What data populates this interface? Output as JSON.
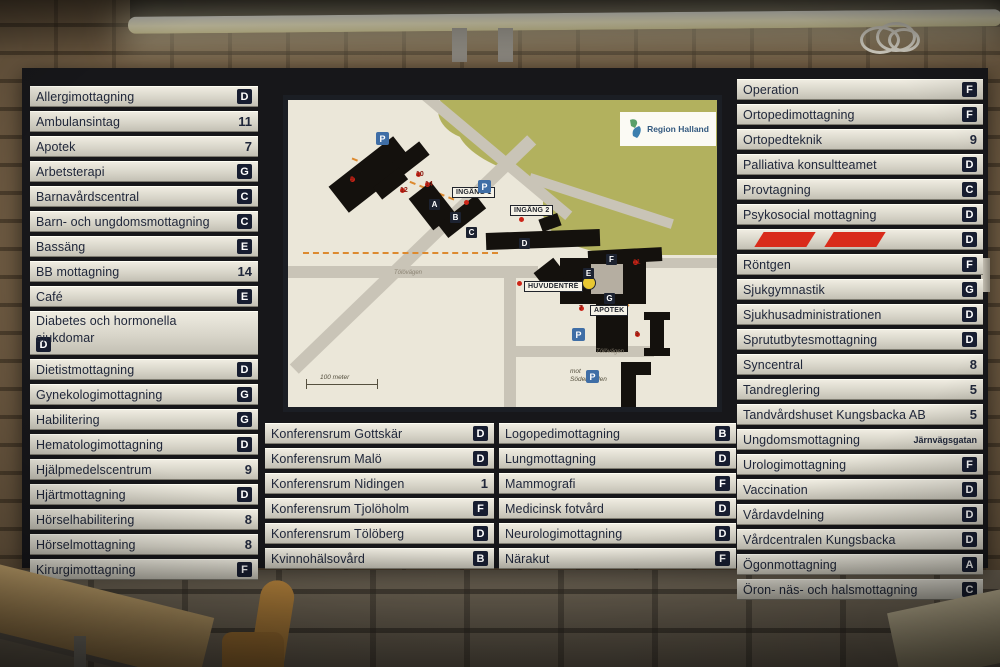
{
  "colors": {
    "badge_bg": "#171d30",
    "row_bg": "#d6d3c7",
    "hazard_red": "#d92b1b",
    "map_green": "#b2b15e",
    "parking_blue": "#3f6ea6",
    "path_orange": "#dd8a2f",
    "marker_red": "#cc2518"
  },
  "sign": {
    "left_column": [
      {
        "label": "Allergimottagning",
        "code": "D",
        "code_type": "badge"
      },
      {
        "label": "Ambulansintag",
        "code": "11",
        "code_type": "num"
      },
      {
        "label": "Apotek",
        "code": "7",
        "code_type": "num"
      },
      {
        "label": "Arbetsterapi",
        "code": "G",
        "code_type": "badge"
      },
      {
        "label": "Barnavårdscentral",
        "code": "C",
        "code_type": "badge"
      },
      {
        "label": "Barn- och ungdomsmottagning",
        "code": "C",
        "code_type": "badge"
      },
      {
        "label": "Bassäng",
        "code": "E",
        "code_type": "badge"
      },
      {
        "label": "BB mottagning",
        "code": "14",
        "code_type": "num"
      },
      {
        "label": "Café",
        "code": "E",
        "code_type": "badge"
      },
      {
        "label": "Diabetes och hormonella sjukdomar",
        "code": "D",
        "code_type": "badge",
        "wrap": true
      },
      {
        "label": "Dietistmottagning",
        "code": "D",
        "code_type": "badge"
      },
      {
        "label": "Gynekologimottagning",
        "code": "G",
        "code_type": "badge"
      },
      {
        "label": "Habilitering",
        "code": "G",
        "code_type": "badge"
      },
      {
        "label": "Hematologimottagning",
        "code": "D",
        "code_type": "badge"
      },
      {
        "label": "Hjälpmedelscentrum",
        "code": "9",
        "code_type": "num"
      },
      {
        "label": "Hjärtmottagning",
        "code": "D",
        "code_type": "badge"
      },
      {
        "label": "Hörselhabilitering",
        "code": "8",
        "code_type": "num"
      },
      {
        "label": "Hörselmottagning",
        "code": "8",
        "code_type": "num"
      },
      {
        "label": "Kirurgimottagning",
        "code": "F",
        "code_type": "badge"
      }
    ],
    "right_column": [
      {
        "label": "Operation",
        "code": "F",
        "code_type": "badge"
      },
      {
        "label": "Ortopedimottagning",
        "code": "F",
        "code_type": "badge"
      },
      {
        "label": "Ortopedteknik",
        "code": "9",
        "code_type": "num"
      },
      {
        "label": "Palliativa konsultteamet",
        "code": "D",
        "code_type": "badge"
      },
      {
        "label": "Provtagning",
        "code": "C",
        "code_type": "badge"
      },
      {
        "label": "Psykosocial mottagning",
        "code": "D",
        "code_type": "badge"
      },
      {
        "label": "",
        "code": "D",
        "code_type": "badge",
        "striped": true
      },
      {
        "label": "Röntgen",
        "code": "F",
        "code_type": "badge"
      },
      {
        "label": "Sjukgymnastik",
        "code": "G",
        "code_type": "badge"
      },
      {
        "label": "Sjukhusadministrationen",
        "code": "D",
        "code_type": "badge"
      },
      {
        "label": "Sprututbytesmottagning",
        "code": "D",
        "code_type": "badge"
      },
      {
        "label": "Syncentral",
        "code": "8",
        "code_type": "num"
      },
      {
        "label": "Tandreglering",
        "code": "5",
        "code_type": "num"
      },
      {
        "label": "Tandvårdshuset Kungsbacka AB",
        "code": "5",
        "code_type": "num"
      },
      {
        "label": "Ungdomsmottagning",
        "code": "Järnvägsgatan",
        "code_type": "text"
      },
      {
        "label": "Urologimottagning",
        "code": "F",
        "code_type": "badge"
      },
      {
        "label": "Vaccination",
        "code": "D",
        "code_type": "badge"
      },
      {
        "label": "Vårdavdelning",
        "code": "D",
        "code_type": "badge"
      },
      {
        "label": "Vårdcentralen Kungsbacka",
        "code": "D",
        "code_type": "badge"
      },
      {
        "label": "Ögonmottagning",
        "code": "A",
        "code_type": "badge"
      },
      {
        "label": "Öron- näs- och halsmottagning",
        "code": "C",
        "code_type": "badge"
      }
    ],
    "bottom_left_column": [
      {
        "label": "Konferensrum Gottskär",
        "code": "D",
        "code_type": "badge"
      },
      {
        "label": "Konferensrum Malö",
        "code": "D",
        "code_type": "badge"
      },
      {
        "label": "Konferensrum Nidingen",
        "code": "1",
        "code_type": "num"
      },
      {
        "label": "Konferensrum Tjolöholm",
        "code": "F",
        "code_type": "badge"
      },
      {
        "label": "Konferensrum Tölöberg",
        "code": "D",
        "code_type": "badge"
      },
      {
        "label": "Kvinnohälsovård",
        "code": "B",
        "code_type": "badge"
      }
    ],
    "bottom_center_column": [
      {
        "label": "Logopedimottagning",
        "code": "B",
        "code_type": "badge"
      },
      {
        "label": "Lungmottagning",
        "code": "D",
        "code_type": "badge"
      },
      {
        "label": "Mammografi",
        "code": "F",
        "code_type": "badge"
      },
      {
        "label": "Medicinsk fotvård",
        "code": "D",
        "code_type": "badge"
      },
      {
        "label": "Neurologimottagning",
        "code": "D",
        "code_type": "badge"
      },
      {
        "label": "Närakut",
        "code": "F",
        "code_type": "badge"
      }
    ],
    "map": {
      "logo": "Region Halland",
      "parking_symbol": "P",
      "labels": {
        "entrance1": "INGÅNG 1",
        "entrance2": "INGÅNG 2",
        "main_entrance": "HUVUDENTRÉ",
        "pharmacy": "APOTEK",
        "scale": "100 meter",
        "direction": "mot\nSöderåleden",
        "road1": "Tölövägen",
        "road2": "Tölövägen"
      },
      "building_badges": [
        {
          "letter": "A",
          "x": 141,
          "y": 99
        },
        {
          "letter": "B",
          "x": 162,
          "y": 112
        },
        {
          "letter": "C",
          "x": 178,
          "y": 127
        },
        {
          "letter": "D",
          "x": 231,
          "y": 138
        },
        {
          "letter": "E",
          "x": 295,
          "y": 168
        },
        {
          "letter": "F",
          "x": 318,
          "y": 154
        },
        {
          "letter": "G",
          "x": 316,
          "y": 193
        },
        {
          "letter": "P",
          "x": 0,
          "y": 0
        }
      ],
      "markers": [
        {
          "n": "9",
          "x": 62,
          "y": 79
        },
        {
          "n": "10",
          "x": 128,
          "y": 74
        },
        {
          "n": "12",
          "x": 112,
          "y": 90
        },
        {
          "n": "14",
          "x": 137,
          "y": 84
        },
        {
          "n": "",
          "x": 176,
          "y": 102
        },
        {
          "n": "",
          "x": 231,
          "y": 119
        },
        {
          "n": "",
          "x": 229,
          "y": 183
        },
        {
          "n": "11",
          "x": 345,
          "y": 162
        },
        {
          "n": "7",
          "x": 291,
          "y": 208
        },
        {
          "n": "9",
          "x": 347,
          "y": 234
        }
      ],
      "parking": [
        {
          "x": 88,
          "y": 32
        },
        {
          "x": 190,
          "y": 80
        },
        {
          "x": 284,
          "y": 228
        },
        {
          "x": 298,
          "y": 270
        }
      ]
    }
  }
}
